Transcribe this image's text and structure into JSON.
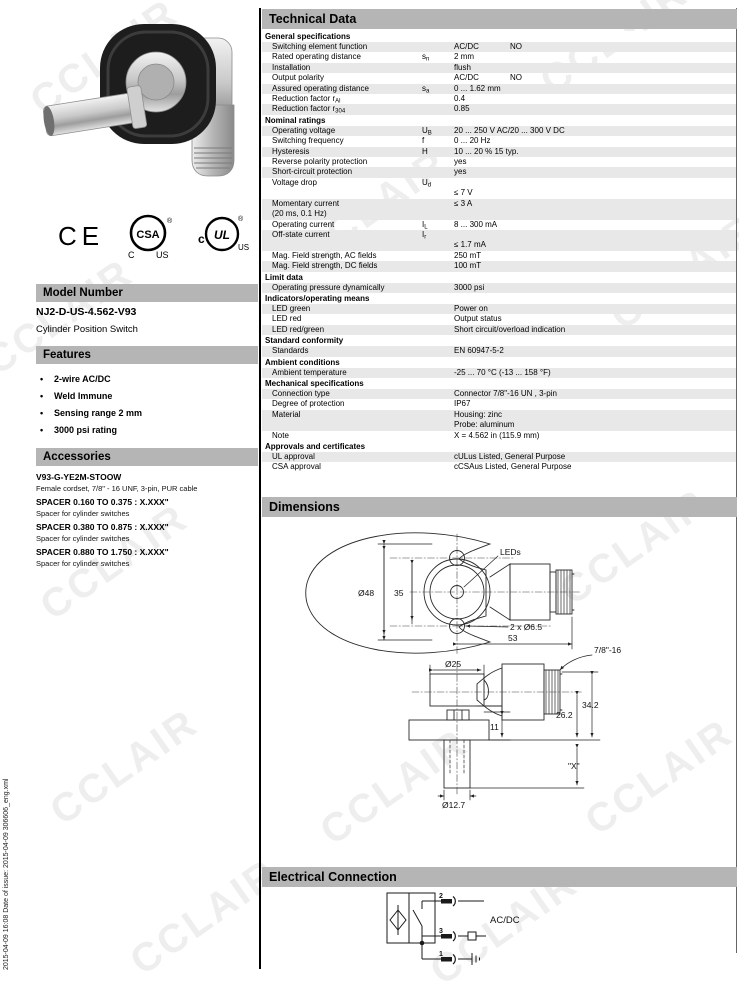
{
  "watermark": "CCLAIR",
  "sidebar": {
    "vertical_text": "2015-04-09 16:08   Date of issue: 2015-04-09   306606_eng.xml"
  },
  "left_column": {
    "model_number": {
      "header": "Model Number",
      "model": "NJ2-D-US-4.562-V93",
      "description": "Cylinder Position Switch"
    },
    "features": {
      "header": "Features",
      "bullet": "•",
      "items": [
        "2-wire AC/DC",
        "Weld Immune",
        "Sensing range 2 mm",
        "3000 psi rating"
      ]
    },
    "accessories": {
      "header": "Accessories",
      "items": [
        {
          "name": "V93-G-YE2M-STOOW",
          "desc": "Female cordset, 7/8\" - 16 UNF, 3-pin, PUR cable"
        },
        {
          "name": "SPACER 0.160 TO 0.375 : X.XXX\"",
          "desc": "Spacer for cylinder switches"
        },
        {
          "name": "SPACER 0.380 TO 0.875 : X.XXX\"",
          "desc": "Spacer for cylinder switches"
        },
        {
          "name": "SPACER 0.880 TO 1.750 : X.XXX\"",
          "desc": "Spacer for cylinder switches"
        }
      ]
    },
    "logos": {
      "ce": "CE",
      "csa": "CSA",
      "csa_c": "C",
      "csa_us": "US",
      "csa_reg": "®",
      "ul": "UL",
      "ul_c": "c",
      "ul_us": "US",
      "ul_reg": "®"
    }
  },
  "technical_data": {
    "header": "Technical Data",
    "sections": [
      {
        "title": "General specifications",
        "rows": [
          {
            "label": "Switching element function",
            "value": "AC/DC",
            "value2": "NO"
          },
          {
            "label": "Rated operating distance",
            "sym": "s",
            "symsub": "n",
            "value": "2 mm"
          },
          {
            "label": "Installation",
            "value": "flush"
          },
          {
            "label": "Output polarity",
            "value": "AC/DC",
            "value2": "NO"
          },
          {
            "label": "Assured operating distance",
            "sym": "s",
            "symsub": "a",
            "value": "0 ... 1.62 mm"
          },
          {
            "label": "Reduction factor r",
            "labelsub": "Al",
            "value": "0.4"
          },
          {
            "label": "Reduction factor r",
            "labelsub": "304",
            "value": "0.85"
          }
        ]
      },
      {
        "title": "Nominal ratings",
        "rows": [
          {
            "label": "Operating voltage",
            "sym": "U",
            "symsub": "B",
            "value": "20 ... 250 V AC/20 ... 300 V DC"
          },
          {
            "label": "Switching frequency",
            "sym": "f",
            "value": "0 ... 20 Hz"
          },
          {
            "label": "Hysteresis",
            "sym": "H",
            "value": "10 ... 20 % 15 typ."
          },
          {
            "label": "Reverse polarity protection",
            "value": "yes"
          },
          {
            "label": "Short-circuit protection",
            "value": "yes"
          },
          {
            "label": "Voltage drop",
            "sym": "U",
            "symsub": "d",
            "value_lines": [
              "",
              "≤ 7 V"
            ]
          },
          {
            "label": "Momentary current",
            "label2": "(20 ms, 0.1 Hz)",
            "value": "≤ 3 A"
          },
          {
            "label": "Operating current",
            "sym": "I",
            "symsub": "L",
            "value": "8 ... 300 mA"
          },
          {
            "label": "Off-state current",
            "sym": "I",
            "symsub": "r",
            "value_lines": [
              "",
              "≤ 1.7 mA"
            ]
          },
          {
            "label": "Mag. Field strength, AC fields",
            "value": "250 mT"
          },
          {
            "label": "Mag. Field strength, DC fields",
            "value": "100 mT"
          }
        ]
      },
      {
        "title": "Limit data",
        "rows": [
          {
            "label": "Operating pressure dynamically",
            "value": "3000 psi"
          }
        ]
      },
      {
        "title": "Indicators/operating means",
        "rows": [
          {
            "label": "LED green",
            "value": "Power on"
          },
          {
            "label": "LED red",
            "value": "Output status"
          },
          {
            "label": "LED red/green",
            "value": "Short circuit/overload indication"
          }
        ]
      },
      {
        "title": "Standard conformity",
        "rows": [
          {
            "label": "Standards",
            "value": "EN 60947-5-2"
          }
        ]
      },
      {
        "title": "Ambient conditions",
        "rows": [
          {
            "label": "Ambient temperature",
            "value": "-25 ... 70 °C (-13 ... 158 °F)"
          }
        ]
      },
      {
        "title": "Mechanical specifications",
        "rows": [
          {
            "label": "Connection type",
            "value": "Connector 7/8\"-16 UN , 3-pin"
          },
          {
            "label": "Degree of protection",
            "value": "IP67"
          },
          {
            "label": "Material",
            "value_lines": [
              "Housing: zinc",
              "Probe: aluminum"
            ]
          },
          {
            "label": "Note",
            "value": "X = 4.562 in (115.9 mm)"
          }
        ]
      },
      {
        "title": "Approvals and certificates",
        "rows": [
          {
            "label": "UL approval",
            "value": "cULus Listed, General Purpose"
          },
          {
            "label": "CSA approval",
            "value": "cCSAus Listed, General Purpose"
          }
        ]
      }
    ]
  },
  "dimensions": {
    "header": "Dimensions",
    "labels": {
      "d48": "Ø48",
      "d35": "35",
      "leds": "LEDs",
      "holes": "2 x Ø6.5",
      "d53": "53",
      "thread": "7/8\"-16",
      "d25": "Ø25",
      "d11": "11",
      "d262": "26.2",
      "d342": "34.2",
      "x": "\"X\"",
      "d127": "Ø12.7"
    }
  },
  "electrical": {
    "header": "Electrical Connection",
    "supply": "AC/DC",
    "pin_top": "2",
    "pin_mid": "3",
    "pin_bottom": "1"
  }
}
